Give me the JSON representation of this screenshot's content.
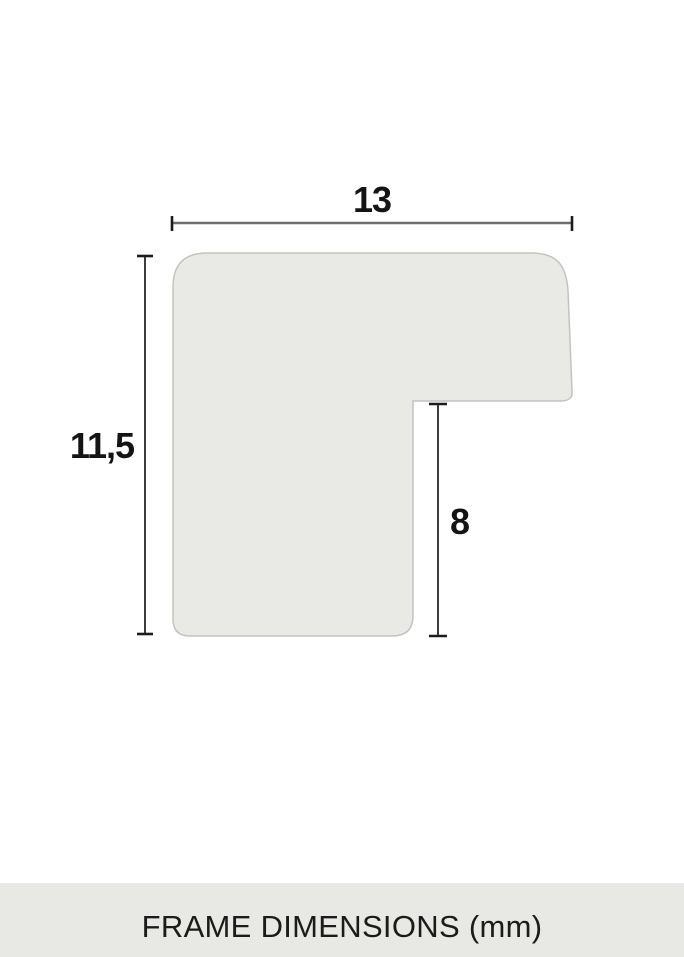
{
  "labels": {
    "width": "13",
    "height": "11,5",
    "notch": "8"
  },
  "footer": {
    "title": "FRAME DIMENSIONS (mm)"
  },
  "colors": {
    "shape_fill": "#e9eae6",
    "shape_border": "#c3c3c0",
    "dim_line_horizontal": "#6e6e6e",
    "dim_line_vertical": "#3c3c3c",
    "dim_tick": "#1c1c1c",
    "label_text": "#141414",
    "footer_background": "#e8e8e4",
    "footer_text": "#1b1b1b",
    "page_background": "#ffffff"
  }
}
